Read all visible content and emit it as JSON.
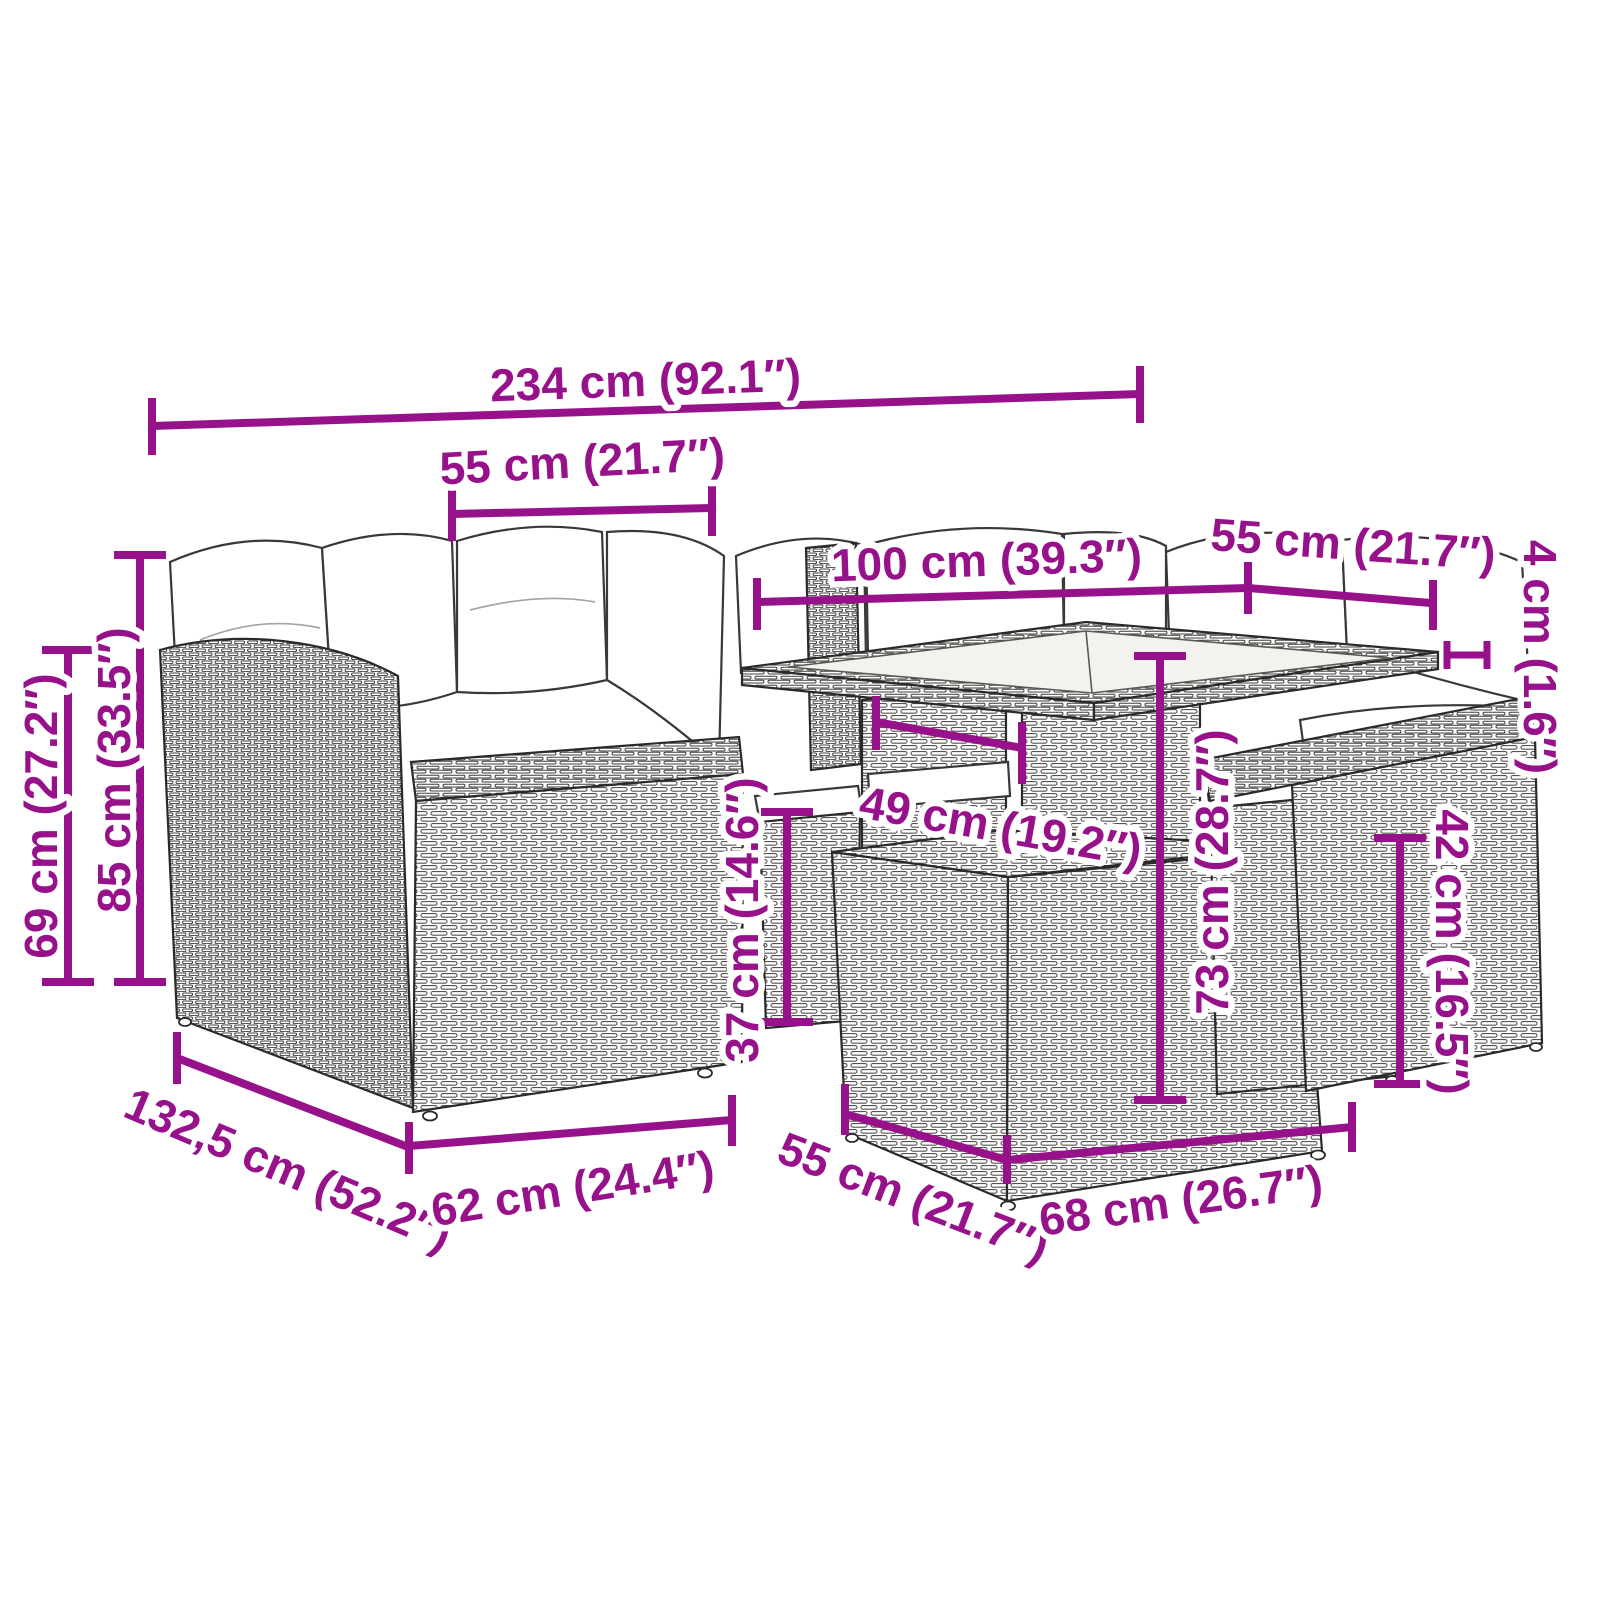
{
  "diagram_type": "furniture-dimension-diagram",
  "subject": "poly-rattan garden lounge set with cushions, glass-top table and ottomans",
  "accent_color": "#97128A",
  "dimensions": {
    "overall_width": {
      "label": "234 cm (92.1″)"
    },
    "backrest_width": {
      "label": "55 cm (21.7″)"
    },
    "table_length": {
      "label": "100 cm (39.3″)"
    },
    "table_width": {
      "label": "55 cm (21.7″)"
    },
    "tabletop_thickness": {
      "label": "4 cm (1.6″)"
    },
    "armrest_height": {
      "label": "69 cm (27.2″)"
    },
    "total_height": {
      "label": "85 cm (33.5″)"
    },
    "under_table_clearance": {
      "label": "49 cm (19.2″)"
    },
    "seat_height": {
      "label": "37 cm (14.6″)"
    },
    "table_height": {
      "label": "73 cm (28.7″)"
    },
    "ottoman_height": {
      "label": "42 cm (16.5″)"
    },
    "overall_depth": {
      "label": "132,5 cm (52.2″)"
    },
    "seat_module_depth": {
      "label": "62 cm (24.4″)"
    },
    "ottoman_depth": {
      "label": "55 cm (21.7″)"
    },
    "ottoman_width": {
      "label": "68 cm (26.7″)"
    }
  }
}
